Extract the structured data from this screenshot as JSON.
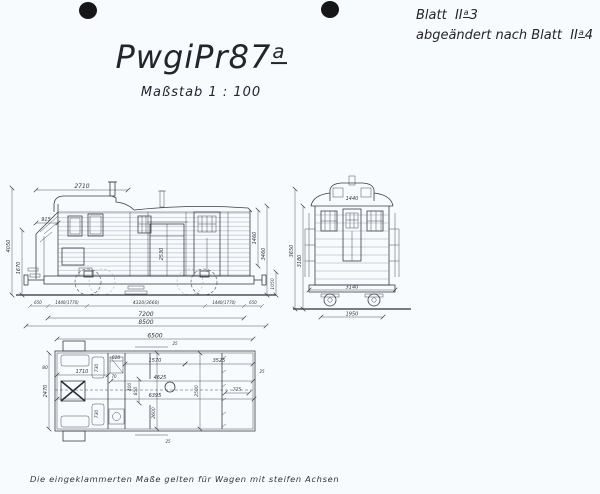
{
  "paper": {
    "background": "#f8fbfe",
    "ink": "#3a3d45",
    "hole_color": "#161618"
  },
  "sheet_note": {
    "line1_pre": "Blatt",
    "line1_roman": "II",
    "line1_sup": "a",
    "line1_num": "3",
    "line2_pre": "abgeändert nach Blatt",
    "line2_roman": "II",
    "line2_sup": "a",
    "line2_num": "4"
  },
  "title": {
    "main": "PwgiPr87",
    "sup": "a",
    "scale": "Maßstab  1 : 100"
  },
  "caption": "Die eingeklammerten Maße gelten für Wagen mit steifen Achsen",
  "side": {
    "dims": {
      "d2710": "2710",
      "d915": "915",
      "d4050": "4050",
      "d1670": "1670",
      "d2530": "2530",
      "d1460": "1460",
      "d3460": "3460",
      "d1050": "1050",
      "o650l": "650",
      "o1440l": "1440(1770)",
      "wheelbase": "4320(3660)",
      "o1440r": "1440(1770)",
      "o650r": "650",
      "d7200": "7200",
      "d8500": "8500"
    }
  },
  "end": {
    "dims": {
      "d1440": "1440",
      "d3650": "3650",
      "d3180": "3180",
      "d3140": "3140",
      "d1950": "1950"
    }
  },
  "plan": {
    "dims": {
      "d6500": "6500",
      "d620": "620",
      "d1570": "1570",
      "d3525": "3525",
      "d80": "80",
      "d1710": "1710",
      "d70": "70",
      "d2470": "2470",
      "seat_top": "730",
      "seat_bot": "730",
      "d400": "400",
      "d850": "850",
      "d4625": "4625",
      "d6395": "6395",
      "d2600": "2600",
      "d2500": "2500",
      "d775": "775",
      "d25_top": "25",
      "d25_right": "25",
      "d25_bottom": "25"
    }
  }
}
